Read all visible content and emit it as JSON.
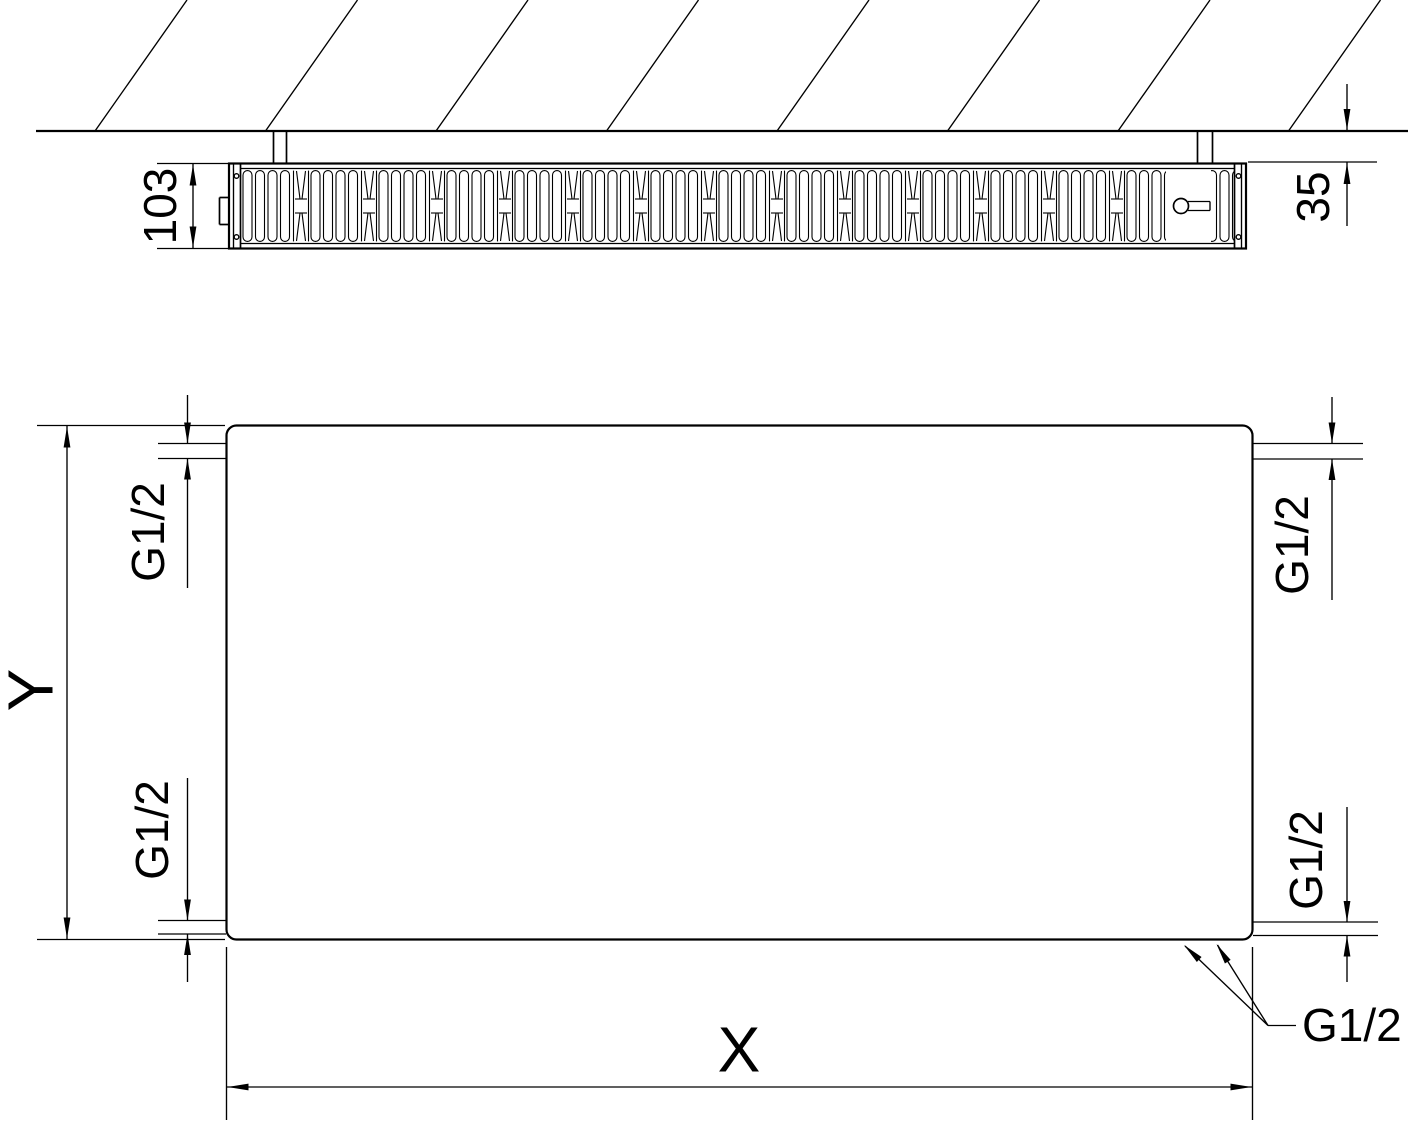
{
  "top_view": {
    "depth_label": "103",
    "wall_gap_label": "35"
  },
  "front_view": {
    "height_label": "Y",
    "width_label": "X",
    "thread_top_left": "G1/2",
    "thread_bottom_left": "G1/2",
    "thread_top_right": "G1/2",
    "thread_bottom_right": "G1/2",
    "thread_leader": "G1/2"
  },
  "colors": {
    "line_color": "#000000",
    "background": "#ffffff"
  }
}
